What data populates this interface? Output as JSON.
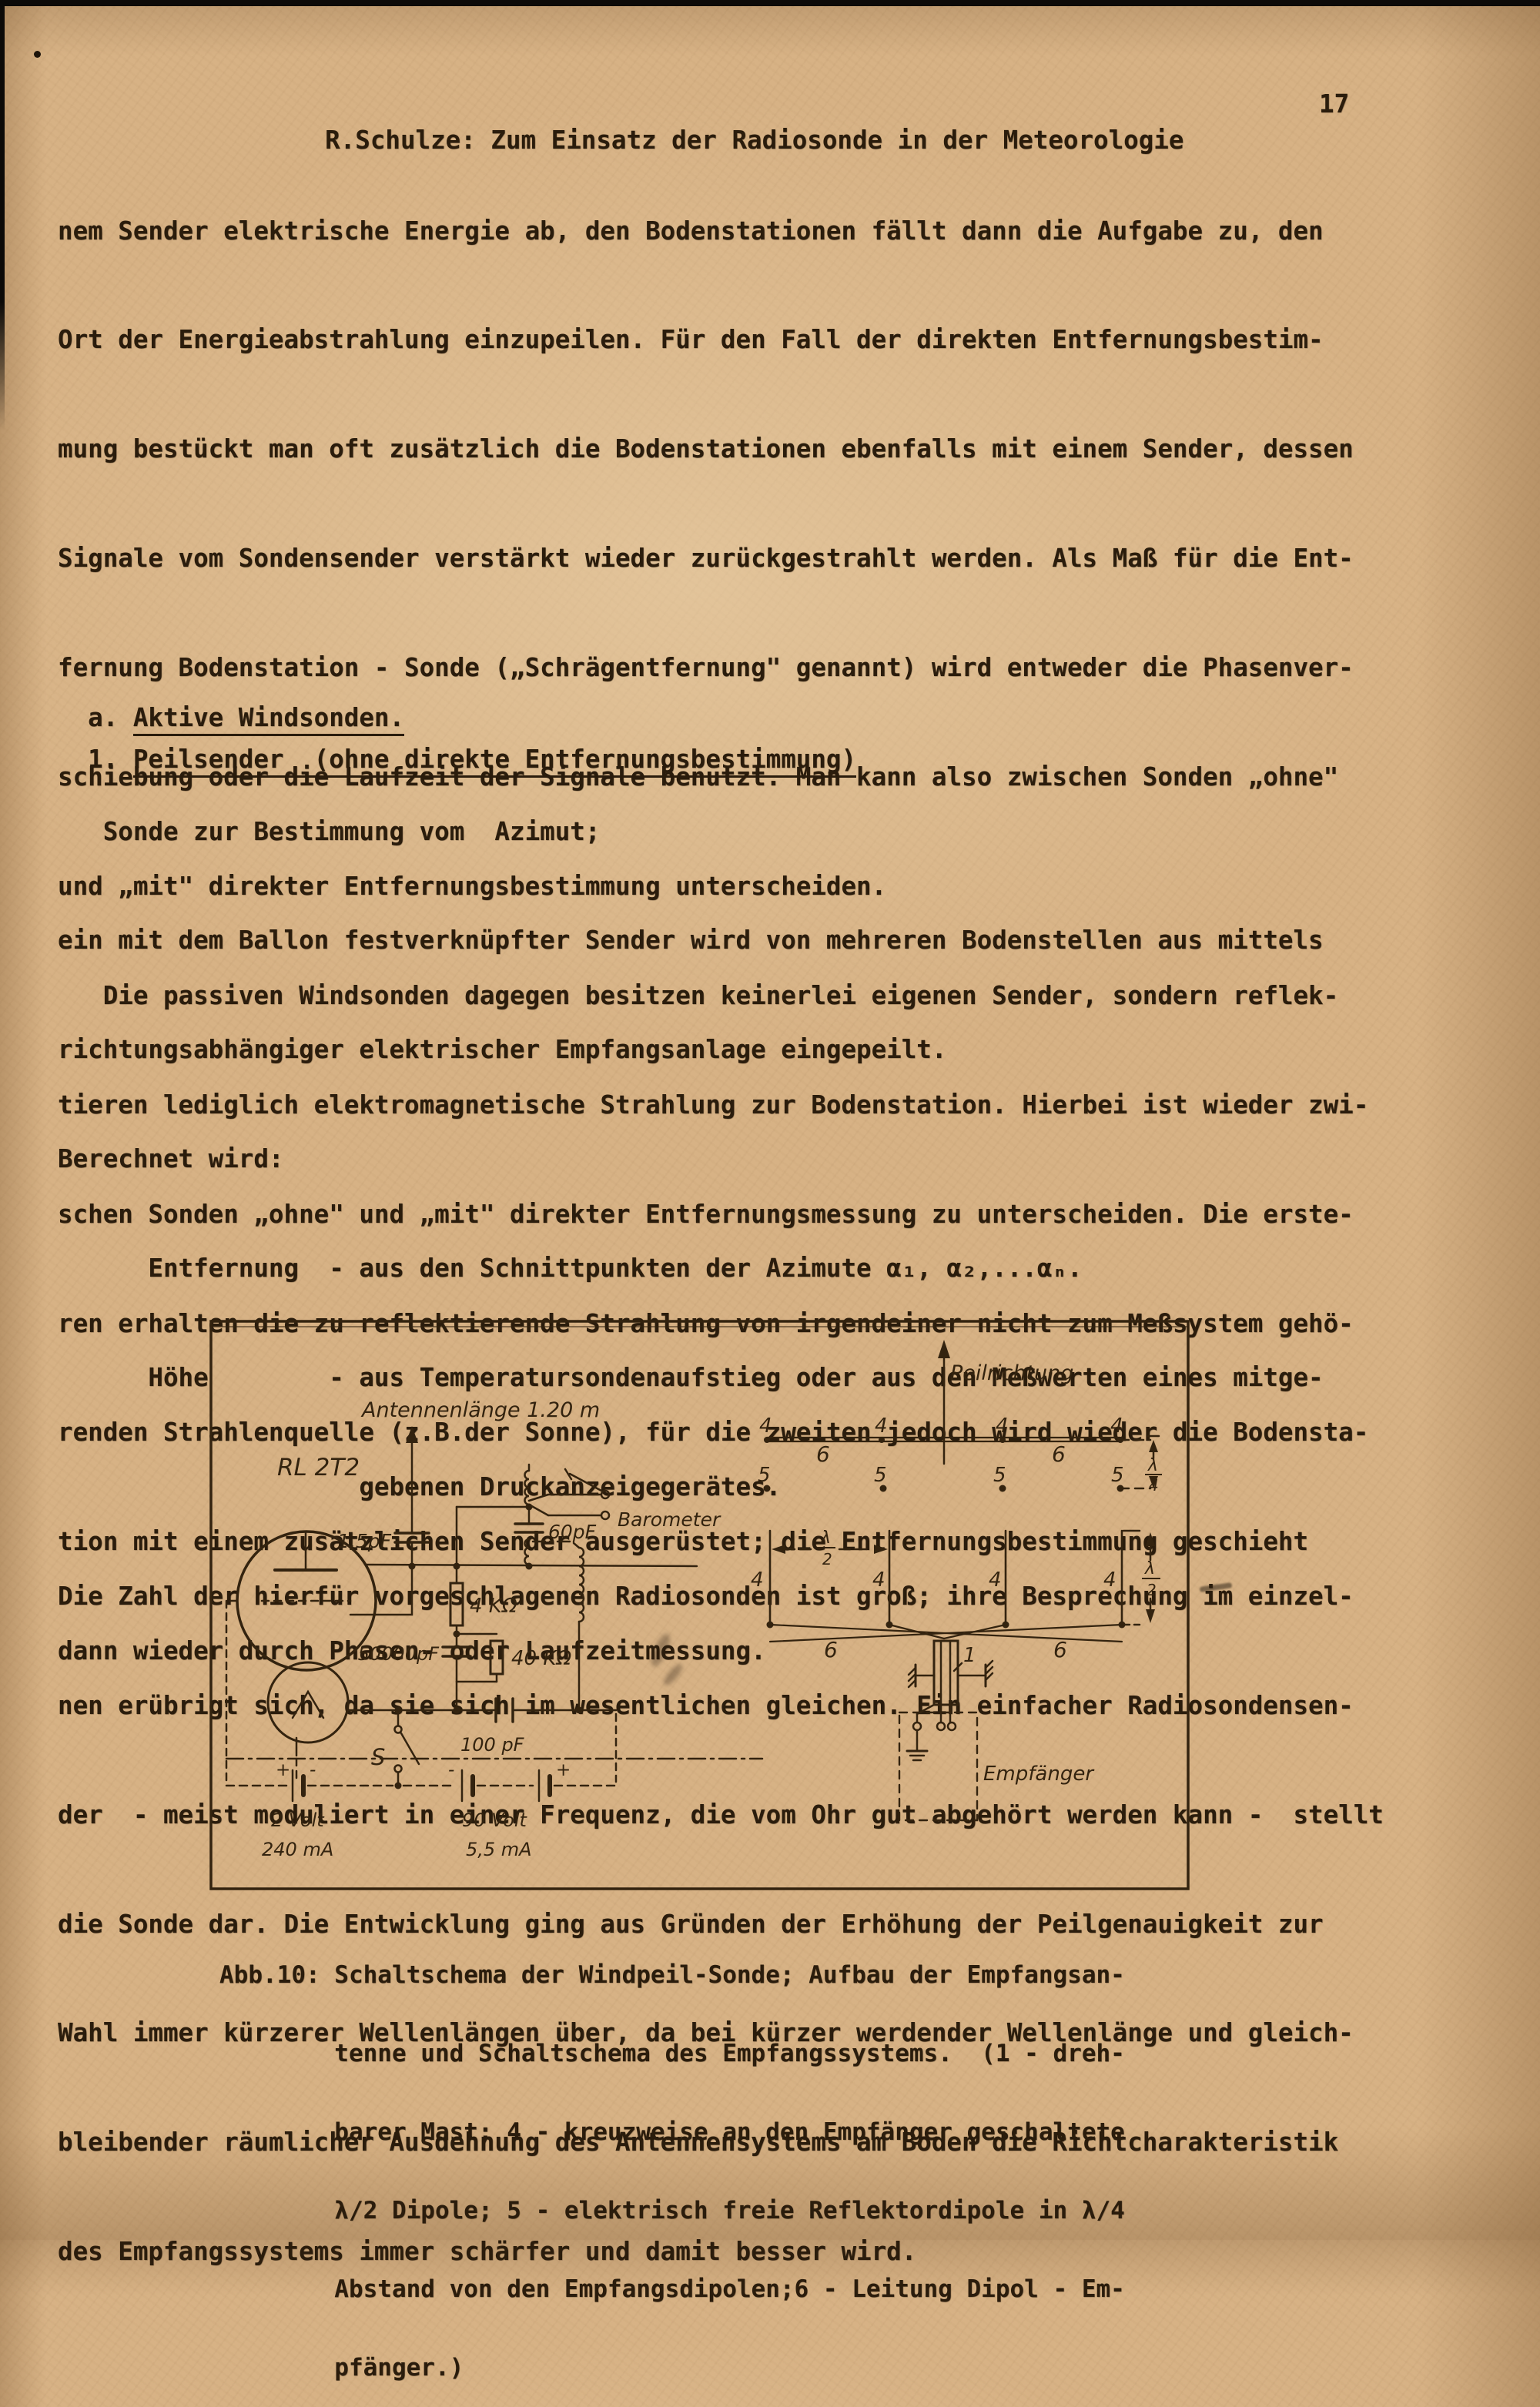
{
  "page": {
    "header": {
      "title": "R.Schulze: Zum Einsatz der Radiosonde in der Meteorologie",
      "page_number": "17"
    },
    "body1": {
      "lines": [
        "nem Sender elektrische Energie ab, den Bodenstationen fällt dann die Aufgabe zu, den",
        "Ort der Energieabstrahlung einzupeilen. Für den Fall der direkten Entfernungsbestim-",
        "mung bestückt man oft zusätzlich die Bodenstationen ebenfalls mit einem Sender, dessen",
        "Signale vom Sondensender verstärkt wieder zurückgestrahlt werden. Als Maß für die Ent-",
        "fernung Bodenstation - Sonde („Schrägentfernung\" genannt) wird entweder die Phasenver-",
        "schiebung oder die Laufzeit der Signale benutzt. Man kann also zwischen Sonden „ohne\"",
        "und „mit\" direkter Entfernungsbestimmung unterscheiden.",
        "   Die passiven Windsonden dagegen besitzen keinerlei eigenen Sender, sondern reflek-",
        "tieren lediglich elektromagnetische Strahlung zur Bodenstation. Hierbei ist wieder zwi-",
        "schen Sonden „ohne\" und „mit\" direkter Entfernungsmessung zu unterscheiden. Die erste-",
        "ren erhalten die zu reflektierende Strahlung von irgendeiner nicht zum Meßsystem gehö-",
        "renden Strahlenquelle (z.B.der Sonne), für die zweiten jedoch wird wieder die Bodensta-",
        "tion mit einem zusätzlichen Sender ausgerüstet; die Entfernungsbestimmung geschieht",
        "dann wieder durch Phasen- oder Laufzeitmessung."
      ]
    },
    "heading_a": {
      "prefix": "a. ",
      "underlined": "Aktive Windsonden."
    },
    "heading_1": {
      "prefix": "1. ",
      "underlined": "Peilsender  (ohne direkte Entfernungsbestimmung)"
    },
    "body2": {
      "lines": [
        "   Sonde zur Bestimmung vom  Azimut;",
        "ein mit dem Ballon festverknüpfter Sender wird von mehreren Bodenstellen aus mittels",
        "richtungsabhängiger elektrischer Empfangsanlage eingepeilt.",
        "Berechnet wird:",
        "      Entfernung  - aus den Schnittpunkten der Azimute α₁, α₂,...αₙ.",
        "      Höhe        - aus Temperatursondenaufstieg oder aus den Meßwerten eines mitge-",
        "                    gebenen Druckanzeigegerätes.",
        "Die Zahl der hierfür vorgeschlagenen Radiosonden ist groß; ihre Besprechung im einzel-",
        "nen erübrigt sich, da sie sich im wesentlichen gleichen. Ein einfacher Radiosondensen-",
        "der  - meist moduliert in einer Frequenz, die vom Ohr gut abgehört werden kann -  stellt",
        "die Sonde dar. Die Entwicklung ging aus Gründen der Erhöhung der Peilgenauigkeit zur",
        "Wahl immer kürzerer Wellenlängen über, da bei kürzer werdender Wellenlänge und gleich-",
        "bleibender räumlicher Ausdehnung des Antennensystems am Boden die Richtcharakteristik",
        "des Empfangssystems immer schärfer und damit besser wird."
      ]
    },
    "caption": {
      "lines": [
        "Abb.10: Schaltschema der Windpeil-Sonde; Aufbau der Empfangsan-",
        "        tenne und Schaltschema des Empfangssystems.  (1 - dreh-",
        "        barer Mast; 4 - kreuzweise an den Empfänger geschaltete",
        "        λ/2 Dipole; 5 - elektrisch freie Reflektordipole in λ/4",
        "        Abstand von den Empfangsdipolen;6 - Leitung Dipol - Em-",
        "        pfänger.)"
      ]
    }
  },
  "figure": {
    "colors": {
      "paper": "#d7b285",
      "ink": "#33230f"
    },
    "circuit": {
      "antenna_label": "Antennenlänge 1.20 m",
      "tube_label": "RL 2T2",
      "c1": "1,5pF",
      "c2": "60pF",
      "r1": "4 KΩ",
      "c3": "50000pF",
      "r2": "40 KΩ",
      "c4": "100 pF",
      "switch_label": "S",
      "barometer_label": "Barometer",
      "battery1_v": "2 Volt",
      "battery1_i": "240 mA",
      "battery2_v": "90 Volt",
      "battery2_i": "5,5 mA",
      "plus": "+",
      "minus": "-"
    },
    "antenna": {
      "direction_label": "Peilrichtung",
      "dipole_num": "4",
      "reflector_num": "5",
      "feed_num": "6",
      "mast_num": "1",
      "receiver_label": "Empfänger",
      "lambda": "λ",
      "two": "2",
      "four": "4"
    }
  }
}
